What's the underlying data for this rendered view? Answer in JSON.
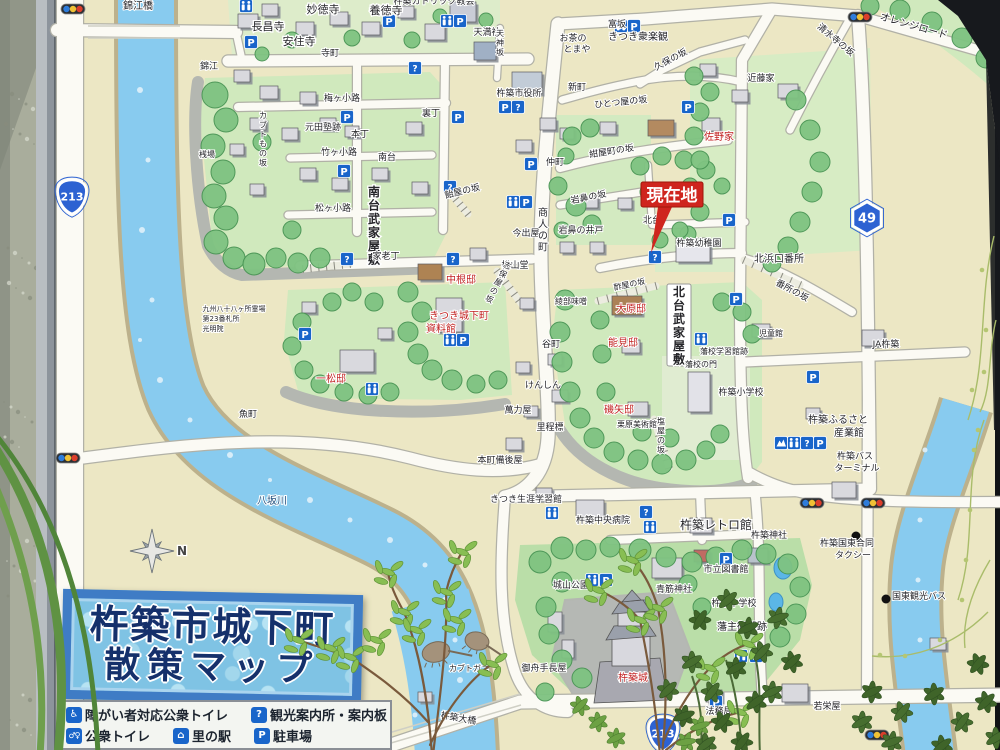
{
  "photo": {
    "wall_color": "#a9ad9b",
    "frame_color": "#c3c8cd",
    "background_dark": "#17191d"
  },
  "sign": {
    "title": {
      "line1": "杵築市城下町",
      "line2": "散策マップ",
      "text_color": "#14306e",
      "bg_color": "#7cc4e6",
      "border_color": "#3c7cc9"
    },
    "legend": {
      "items": [
        {
          "icon": "accessible-toilet-icon",
          "glyph": "♿",
          "label": "障がい者対応公衆トイレ"
        },
        {
          "icon": "info-icon",
          "glyph": "?",
          "label": "観光案内所・案内板"
        },
        {
          "icon": "toilet-icon",
          "glyph": "♂♀",
          "label": "公衆トイレ"
        },
        {
          "icon": "sato-no-eki-icon",
          "glyph": "⌂",
          "label": "里の駅"
        },
        {
          "icon": "parking-icon",
          "glyph": "P",
          "label": "駐車場"
        }
      ]
    },
    "current_location": {
      "label": "現在地",
      "color": "#d6231c"
    },
    "compass_label": "N",
    "accent": {
      "parking_blue": "#1565d0",
      "label_red": "#c81e1e",
      "river_blue": "#85ccf1"
    },
    "route_shields": [
      {
        "number": "213",
        "type": "national",
        "x": 72,
        "y": 196
      },
      {
        "number": "213",
        "type": "national",
        "x": 663,
        "y": 733
      },
      {
        "number": "49",
        "type": "prefectural",
        "x": 867,
        "y": 218
      }
    ],
    "labels": [
      {
        "t": "錦江橋",
        "x": 138,
        "y": 9,
        "s": 10
      },
      {
        "t": "妙徳寺",
        "x": 323,
        "y": 13,
        "s": 11
      },
      {
        "t": "養徳寺",
        "x": 386,
        "y": 14,
        "s": 11
      },
      {
        "t": "長昌寺",
        "x": 268,
        "y": 30,
        "s": 11
      },
      {
        "t": "安住寺",
        "x": 299,
        "y": 45,
        "s": 11
      },
      {
        "t": "杵築カトリック教会",
        "x": 434,
        "y": 4,
        "s": 9
      },
      {
        "t": "天満社",
        "x": 487,
        "y": 35,
        "s": 9
      },
      {
        "t": "寺町",
        "x": 330,
        "y": 56,
        "s": 9
      },
      {
        "t": "錦江",
        "x": 209,
        "y": 69,
        "s": 9
      },
      {
        "t": "お茶の",
        "x": 573,
        "y": 41,
        "s": 9
      },
      {
        "t": "とまや",
        "x": 577,
        "y": 52,
        "s": 9
      },
      {
        "t": "富坂",
        "x": 617,
        "y": 27,
        "s": 9
      },
      {
        "t": "きつき衆楽観",
        "x": 638,
        "y": 40,
        "s": 10
      },
      {
        "t": "久保の坂",
        "x": 672,
        "y": 62,
        "s": 9,
        "r": -28
      },
      {
        "t": "清水寺の坂",
        "x": 834,
        "y": 42,
        "s": 9,
        "r": 40
      },
      {
        "t": "オレンジロード",
        "x": 913,
        "y": 29,
        "s": 10,
        "r": 16
      },
      {
        "t": "近藤家",
        "x": 761,
        "y": 81,
        "s": 9
      },
      {
        "t": "佐野家",
        "x": 719,
        "y": 140,
        "s": 10,
        "c": "r"
      },
      {
        "t": "新町",
        "x": 577,
        "y": 90,
        "s": 9
      },
      {
        "t": "杵築市役所",
        "x": 519,
        "y": 96,
        "s": 9
      },
      {
        "t": "ひとつ屋の坂",
        "x": 621,
        "y": 105,
        "s": 9,
        "r": -6
      },
      {
        "t": "梅ヶ小路",
        "x": 342,
        "y": 101,
        "s": 9
      },
      {
        "t": "カブトもの坂",
        "x": 263,
        "y": 118,
        "s": 8,
        "v": 1
      },
      {
        "t": "元田塾跡",
        "x": 323,
        "y": 130,
        "s": 9
      },
      {
        "t": "本丁",
        "x": 360,
        "y": 137,
        "s": 9
      },
      {
        "t": "竹ヶ小路",
        "x": 339,
        "y": 155,
        "s": 9
      },
      {
        "t": "南台",
        "x": 387,
        "y": 160,
        "s": 9
      },
      {
        "t": "裏丁",
        "x": 431,
        "y": 116,
        "s": 9
      },
      {
        "t": "桟場",
        "x": 207,
        "y": 157,
        "s": 8
      },
      {
        "t": "松ヶ小路",
        "x": 333,
        "y": 211,
        "s": 9
      },
      {
        "t": "南台武家屋敷",
        "x": 374,
        "y": 196,
        "s": 12,
        "v": 1,
        "b": 1
      },
      {
        "t": "飴屋の坂",
        "x": 463,
        "y": 194,
        "s": 9,
        "r": -14
      },
      {
        "t": "仲町",
        "x": 555,
        "y": 165,
        "s": 9
      },
      {
        "t": "紺屋町の坂",
        "x": 612,
        "y": 154,
        "s": 9,
        "r": -9
      },
      {
        "t": "岩鼻の坂",
        "x": 589,
        "y": 200,
        "s": 9,
        "r": -11
      },
      {
        "t": "岩鼻の井戸",
        "x": 581,
        "y": 233,
        "s": 9
      },
      {
        "t": "今出屋",
        "x": 526,
        "y": 236,
        "s": 9
      },
      {
        "t": "商人の町",
        "x": 543,
        "y": 216,
        "s": 10,
        "v": 1
      },
      {
        "t": "北台",
        "x": 652,
        "y": 223,
        "s": 9
      },
      {
        "t": "杵築幼稚園",
        "x": 699,
        "y": 246,
        "s": 9
      },
      {
        "t": "北浜口番所",
        "x": 779,
        "y": 262,
        "s": 10
      },
      {
        "t": "番所の坂",
        "x": 791,
        "y": 293,
        "s": 9,
        "r": 28
      },
      {
        "t": "松山堂",
        "x": 515,
        "y": 268,
        "s": 9
      },
      {
        "t": "綾部味噌",
        "x": 571,
        "y": 304,
        "s": 8
      },
      {
        "t": "家老丁",
        "x": 386,
        "y": 259,
        "s": 9
      },
      {
        "t": "中根邸",
        "x": 461,
        "y": 283,
        "s": 10,
        "c": "r"
      },
      {
        "t": "きつき城下町",
        "x": 459,
        "y": 319,
        "s": 10,
        "c": "r"
      },
      {
        "t": "資料館",
        "x": 441,
        "y": 332,
        "s": 10,
        "c": "r"
      },
      {
        "t": "一松邸",
        "x": 331,
        "y": 382,
        "s": 10,
        "c": "r"
      },
      {
        "t": "九州八十八ヶ所霊場",
        "x": 234,
        "y": 311,
        "s": 7
      },
      {
        "t": "第23番札所",
        "x": 221,
        "y": 321,
        "s": 7
      },
      {
        "t": "光明院",
        "x": 213,
        "y": 331,
        "s": 7
      },
      {
        "t": "魚町",
        "x": 248,
        "y": 417,
        "s": 9
      },
      {
        "t": "大原邸",
        "x": 631,
        "y": 312,
        "s": 10,
        "c": "r"
      },
      {
        "t": "能見邸",
        "x": 623,
        "y": 346,
        "s": 10,
        "c": "r"
      },
      {
        "t": "磯矢邸",
        "x": 619,
        "y": 413,
        "s": 10,
        "c": "r"
      },
      {
        "t": "栗原美術館",
        "x": 637,
        "y": 427,
        "s": 8
      },
      {
        "t": "北台武家屋敷",
        "x": 679,
        "y": 296,
        "s": 12,
        "v": 1,
        "b": 1
      },
      {
        "t": "藩校学習館跡",
        "x": 724,
        "y": 354,
        "s": 8
      },
      {
        "t": "藩校の門",
        "x": 701,
        "y": 367,
        "s": 8
      },
      {
        "t": "杵築小学校",
        "x": 741,
        "y": 395,
        "s": 9
      },
      {
        "t": "児童館",
        "x": 771,
        "y": 336,
        "s": 8
      },
      {
        "t": "谷町",
        "x": 551,
        "y": 347,
        "s": 9
      },
      {
        "t": "けんしん",
        "x": 543,
        "y": 388,
        "s": 9
      },
      {
        "t": "萬力屋",
        "x": 518,
        "y": 413,
        "s": 9
      },
      {
        "t": "里程標",
        "x": 550,
        "y": 430,
        "s": 9
      },
      {
        "t": "本町備後屋",
        "x": 500,
        "y": 463,
        "s": 9
      },
      {
        "t": "きつき生涯学習館",
        "x": 526,
        "y": 502,
        "s": 9
      },
      {
        "t": "杵築中央病院",
        "x": 603,
        "y": 523,
        "s": 9
      },
      {
        "t": "杵築レトロ館",
        "x": 716,
        "y": 529,
        "s": 12
      },
      {
        "t": "杵築神社",
        "x": 769,
        "y": 538,
        "s": 9
      },
      {
        "t": "杵築国東合同",
        "x": 847,
        "y": 546,
        "s": 9
      },
      {
        "t": "タクシー",
        "x": 853,
        "y": 558,
        "s": 9
      },
      {
        "t": "JA杵築",
        "x": 886,
        "y": 347,
        "s": 9
      },
      {
        "t": "杵築ふるさと",
        "x": 838,
        "y": 423,
        "s": 10
      },
      {
        "t": "産業館",
        "x": 849,
        "y": 436,
        "s": 10
      },
      {
        "t": "杵築バス",
        "x": 855,
        "y": 459,
        "s": 9
      },
      {
        "t": "ターミナル",
        "x": 857,
        "y": 471,
        "s": 9
      },
      {
        "t": "城山公園",
        "x": 571,
        "y": 588,
        "s": 9
      },
      {
        "t": "市立図書館",
        "x": 726,
        "y": 572,
        "s": 9
      },
      {
        "t": "青筋神社",
        "x": 674,
        "y": 592,
        "s": 9
      },
      {
        "t": "杵築中学校",
        "x": 734,
        "y": 606,
        "s": 9
      },
      {
        "t": "藩主御殿跡",
        "x": 742,
        "y": 630,
        "s": 10
      },
      {
        "t": "杵築城",
        "x": 633,
        "y": 681,
        "s": 10,
        "c": "r"
      },
      {
        "t": "御舟手長屋",
        "x": 544,
        "y": 671,
        "s": 9
      },
      {
        "t": "法務局",
        "x": 719,
        "y": 714,
        "s": 9
      },
      {
        "t": "若栄屋",
        "x": 827,
        "y": 709,
        "s": 9
      },
      {
        "t": "国東観光バス",
        "x": 919,
        "y": 599,
        "s": 9
      },
      {
        "t": "八坂川",
        "x": 272,
        "y": 504,
        "s": 10,
        "c": "#1f4f80"
      },
      {
        "t": "杵築大橋",
        "x": 458,
        "y": 721,
        "s": 9,
        "r": 10
      },
      {
        "t": "カブトガニ",
        "x": 469,
        "y": 671,
        "s": 8
      },
      {
        "t": "酢屋の坂",
        "x": 630,
        "y": 287,
        "s": 8,
        "r": -12
      },
      {
        "t": "志保屋の坂",
        "x": 506,
        "y": 268,
        "s": 8,
        "v": 1,
        "r": 28
      },
      {
        "t": "塩屋の坂",
        "x": 661,
        "y": 424,
        "s": 8,
        "v": 1
      },
      {
        "t": "天神坂",
        "x": 500,
        "y": 36,
        "s": 8,
        "v": 1
      },
      {
        "t": "N",
        "x": 182,
        "y": 555,
        "s": 12,
        "c": "#444",
        "b": 1
      }
    ],
    "icons": [
      {
        "k": "toilet",
        "x": 246,
        "y": 6
      },
      {
        "k": "parking",
        "x": 251,
        "y": 42
      },
      {
        "k": "parking",
        "x": 389,
        "y": 21
      },
      {
        "k": "toilet",
        "x": 447,
        "y": 21
      },
      {
        "k": "parking",
        "x": 460,
        "y": 21
      },
      {
        "k": "info",
        "x": 415,
        "y": 68
      },
      {
        "k": "parking",
        "x": 347,
        "y": 117
      },
      {
        "k": "parking",
        "x": 458,
        "y": 117
      },
      {
        "k": "parking",
        "x": 344,
        "y": 171
      },
      {
        "k": "info",
        "x": 450,
        "y": 187
      },
      {
        "k": "toilet",
        "x": 621,
        "y": 26
      },
      {
        "k": "parking",
        "x": 634,
        "y": 26
      },
      {
        "k": "parking",
        "x": 688,
        "y": 107
      },
      {
        "k": "parking",
        "x": 505,
        "y": 107
      },
      {
        "k": "info",
        "x": 518,
        "y": 107
      },
      {
        "k": "parking",
        "x": 531,
        "y": 164
      },
      {
        "k": "toilet",
        "x": 513,
        "y": 202
      },
      {
        "k": "parking",
        "x": 526,
        "y": 202
      },
      {
        "k": "info",
        "x": 655,
        "y": 257
      },
      {
        "k": "parking",
        "x": 729,
        "y": 220
      },
      {
        "k": "info",
        "x": 347,
        "y": 259
      },
      {
        "k": "info",
        "x": 453,
        "y": 259
      },
      {
        "k": "parking",
        "x": 305,
        "y": 334
      },
      {
        "k": "toilet",
        "x": 450,
        "y": 340
      },
      {
        "k": "parking",
        "x": 463,
        "y": 340
      },
      {
        "k": "toilet",
        "x": 372,
        "y": 389
      },
      {
        "k": "parking",
        "x": 736,
        "y": 299
      },
      {
        "k": "toilet",
        "x": 701,
        "y": 339
      },
      {
        "k": "parking",
        "x": 813,
        "y": 377
      },
      {
        "k": "sato",
        "x": 781,
        "y": 443
      },
      {
        "k": "toilet",
        "x": 794,
        "y": 443
      },
      {
        "k": "info",
        "x": 807,
        "y": 443
      },
      {
        "k": "parking",
        "x": 820,
        "y": 443
      },
      {
        "k": "toilet",
        "x": 552,
        "y": 513
      },
      {
        "k": "info",
        "x": 646,
        "y": 512
      },
      {
        "k": "toilet",
        "x": 650,
        "y": 527
      },
      {
        "k": "toilet",
        "x": 592,
        "y": 580
      },
      {
        "k": "parking",
        "x": 606,
        "y": 580
      },
      {
        "k": "parking",
        "x": 726,
        "y": 559
      },
      {
        "k": "toilet",
        "x": 741,
        "y": 656
      },
      {
        "k": "parking",
        "x": 756,
        "y": 656
      },
      {
        "k": "parking",
        "x": 716,
        "y": 702
      },
      {
        "k": "light",
        "x": 73,
        "y": 9
      },
      {
        "k": "light",
        "x": 860,
        "y": 17
      },
      {
        "k": "light",
        "x": 68,
        "y": 458
      },
      {
        "k": "light",
        "x": 812,
        "y": 503
      },
      {
        "k": "light",
        "x": 873,
        "y": 503
      },
      {
        "k": "light",
        "x": 877,
        "y": 735
      },
      {
        "k": "dot",
        "x": 886,
        "y": 599
      },
      {
        "k": "dot",
        "x": 856,
        "y": 536
      }
    ]
  }
}
